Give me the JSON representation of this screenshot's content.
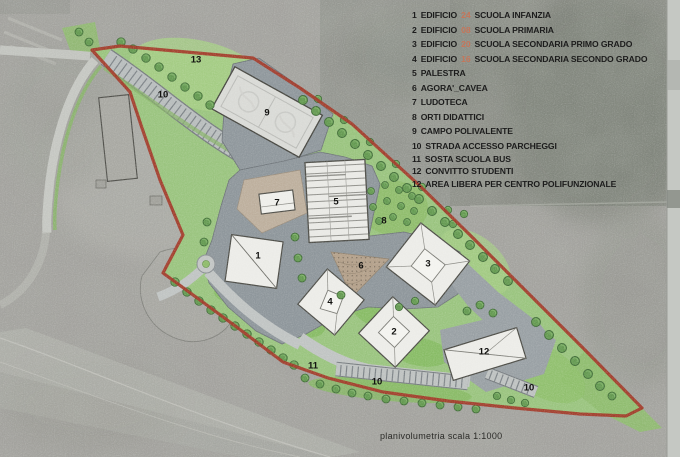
{
  "colors": {
    "boundary_red": "#a23828",
    "lawn_green": "#9ac47f",
    "tree_green": "#649a51",
    "plaza_gray": "#8e969b",
    "road_gray": "#bfc3c2",
    "building_fill": "#ecece8",
    "legend_code_orange": "#c5765a",
    "legend_text": "#1c1c1c"
  },
  "legend": {
    "items": [
      {
        "num": "1",
        "pre": "EDIFICIO",
        "code": "24",
        "post": "SCUOLA INFANZIA"
      },
      {
        "num": "2",
        "pre": "EDIFICIO",
        "code": "08",
        "post": "SCUOLA PRIMARIA"
      },
      {
        "num": "3",
        "pre": "EDIFICIO",
        "code": "20",
        "post": "SCUOLA SECONDARIA PRIMO GRADO"
      },
      {
        "num": "4",
        "pre": "EDIFICIO",
        "code": "16",
        "post": "SCUOLA SECONDARIA SECONDO GRADO"
      },
      {
        "num": "5",
        "label": "PALESTRA"
      },
      {
        "num": "6",
        "label": "AGORA'_CAVEA"
      },
      {
        "num": "7",
        "label": "LUDOTECA"
      },
      {
        "num": "8",
        "label": "ORTI DIDATTICI"
      },
      {
        "num": "9",
        "label": "CAMPO POLIVALENTE"
      },
      {
        "num": "10",
        "label": "STRADA ACCESSO PARCHEGGI"
      },
      {
        "num": "11",
        "label": "SOSTA SCUOLA BUS"
      },
      {
        "num": "12",
        "label": "CONVITTO STUDENTI"
      },
      {
        "num": "12",
        "label": "AREA LIBERA PER CENTRO POLIFUNZIONALE"
      }
    ]
  },
  "plan": {
    "labels": {
      "b1": "1",
      "b2": "2",
      "b3": "3",
      "b4": "4",
      "b5": "5",
      "b6": "6",
      "b7": "7",
      "b8": "8",
      "b9": "9",
      "b12": "12",
      "area13": "13",
      "parking_top": "10",
      "parking_mid": "10",
      "parking_right": "10",
      "bus": "11"
    }
  },
  "caption": {
    "text": "planivolumetria scala 1:1000"
  }
}
